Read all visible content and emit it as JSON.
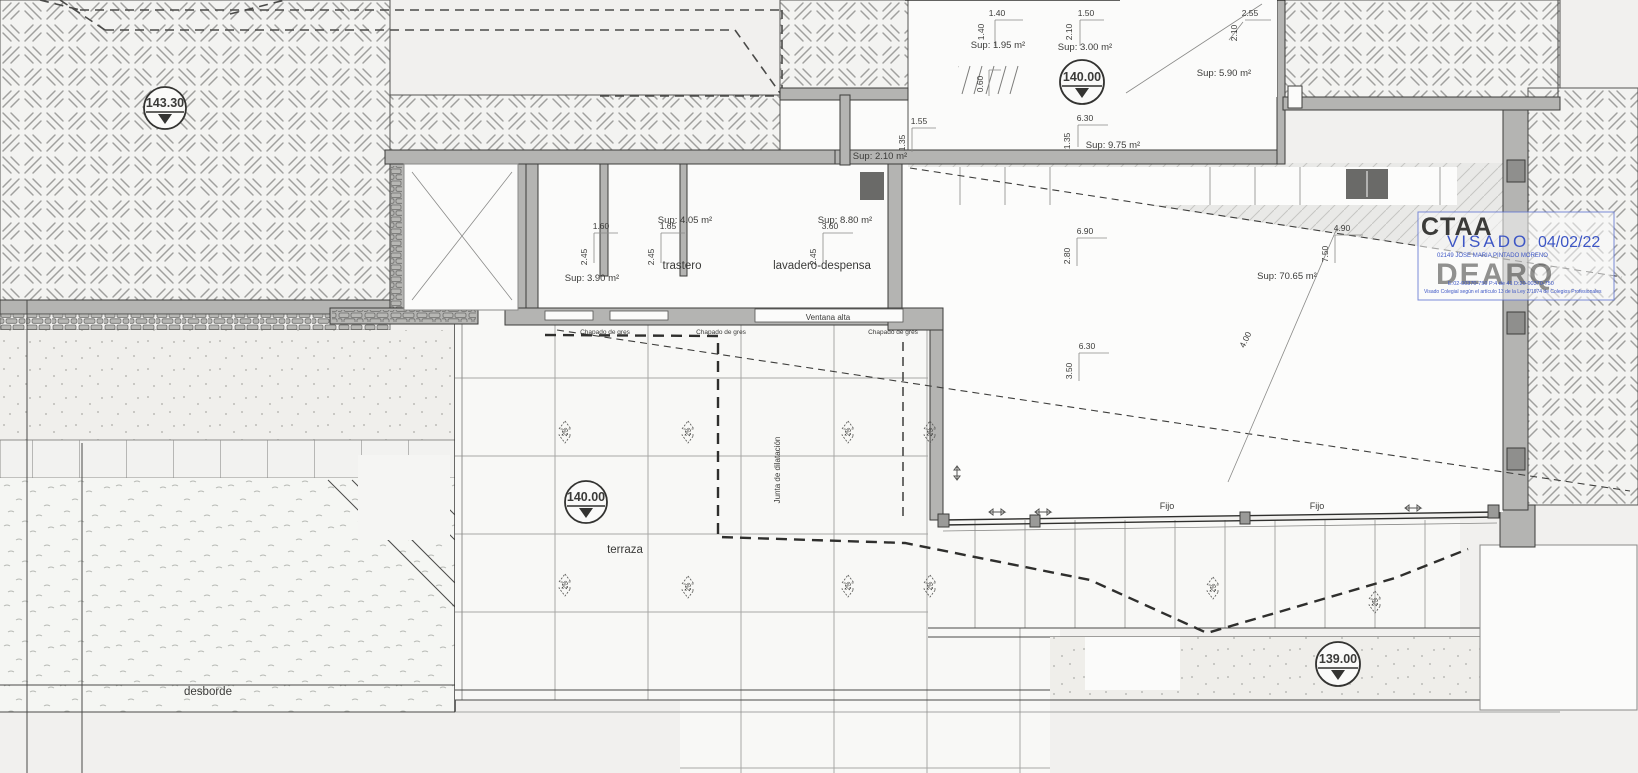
{
  "drawing": {
    "type": "architectural-floor-plan",
    "levels": {
      "roof": "143.30",
      "entry": "140.00",
      "terrace": "140.00",
      "lower": "139.00"
    },
    "rooms": {
      "trastero": "trastero",
      "lavadero": "lavadero-despensa",
      "terraza": "terraza",
      "pool": "desborde"
    },
    "areas": {
      "a195": "Sup: 1.95 m²",
      "a300": "Sup: 3.00 m²",
      "a975": "Sup: 9.75 m²",
      "a590": "Sup: 5.90 m²",
      "a210": "Sup: 2.10 m²",
      "a390": "Sup: 3.90 m²",
      "a405": "Sup: 4.05 m²",
      "a880": "Sup: 8.80 m²",
      "a7065": "Sup: 70.65 m²"
    },
    "dims": {
      "d140": "1.40",
      "d150": "1.50",
      "d210": "2.10",
      "d630": "6.30",
      "d135": "1.35",
      "d255": "2.55",
      "d155": "1.55",
      "d060": "0.60",
      "d160": "1.60",
      "d245": "2.45",
      "d165": "1.65",
      "d360": "3.60",
      "d690": "6.90",
      "d280": "2.80",
      "d350": "3.50",
      "d490": "4.90",
      "d750": "7.50",
      "d400": "4.00"
    },
    "annotations": {
      "ventana_alta": "Ventana alta",
      "chapado": "Chapado de gres",
      "junta": "Junta de dilatación",
      "fijo": "Fijo",
      "slope": "2%"
    },
    "stamp": {
      "org": "CTAA",
      "action": "VISADO",
      "date": "04/02/22",
      "holder": "02149 JOSE MARIA PINTADO MORENO",
      "ref_line": "E:02-00370-750    P:4 de 41    D:20-00370-750",
      "legal_line": "Visado Colegial según el artículo 13 de la Ley 2/1974 de Colegios Profesionales",
      "watermark": "DEARQ"
    },
    "colors": {
      "paper": "#f1f0ee",
      "wall_gray": "#b4b4b2",
      "line_dark": "#3d3d3b",
      "stamp_blue": "#3d56c5",
      "stamp_gray": "#949ead"
    }
  }
}
